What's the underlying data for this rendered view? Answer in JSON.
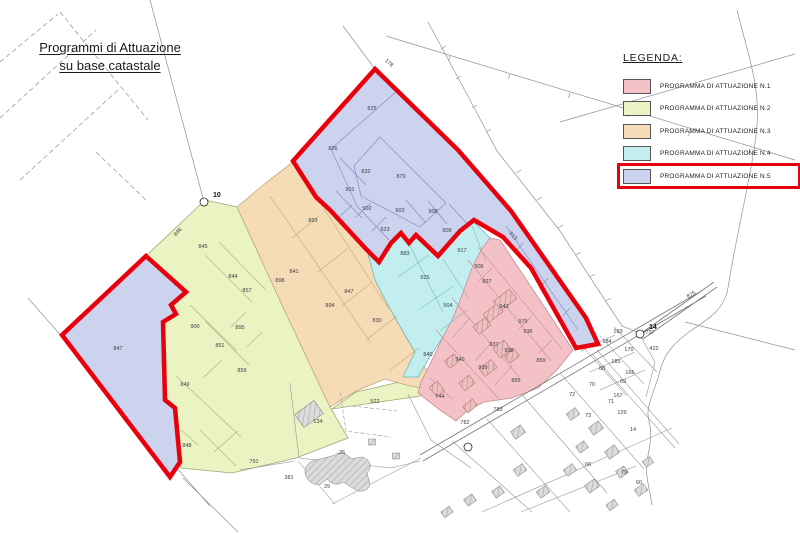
{
  "title": {
    "line1": "Programmi di Attuazione",
    "line2": "su base catastale"
  },
  "legend": {
    "heading": "LEGENDA:",
    "items": [
      {
        "label": "PROGRAMMA DI ATTUAZIONE N.1",
        "color": "#f3c1c6",
        "highlighted": false
      },
      {
        "label": "PROGRAMMA DI ATTUAZIONE N.2",
        "color": "#eaf3c2",
        "highlighted": false
      },
      {
        "label": "PROGRAMMA DI ATTUAZIONE N.3",
        "color": "#f6dcb6",
        "highlighted": false
      },
      {
        "label": "PROGRAMMA DI ATTUAZIONE N.4",
        "color": "#c2eef0",
        "highlighted": false
      },
      {
        "label": "PROGRAMMA DI ATTUAZIONE N.5",
        "color": "#cbd3ee",
        "highlighted": true
      }
    ],
    "highlight_color": "#e8000d"
  },
  "map": {
    "markers": [
      {
        "label": "10",
        "cx": 204,
        "cy": 202,
        "tx": 213,
        "ty": 197
      },
      {
        "label": "14",
        "cx": 640,
        "cy": 334,
        "tx": 649,
        "ty": 329
      },
      {
        "label": "",
        "cx": 468,
        "cy": 447,
        "tx": 0,
        "ty": 0
      }
    ],
    "parcels": [
      {
        "label": "825",
        "x": 372,
        "y": 110
      },
      {
        "label": "826",
        "x": 333,
        "y": 150
      },
      {
        "label": "832",
        "x": 366,
        "y": 173
      },
      {
        "label": "879",
        "x": 401,
        "y": 178
      },
      {
        "label": "901",
        "x": 350,
        "y": 191
      },
      {
        "label": "902",
        "x": 367,
        "y": 210
      },
      {
        "label": "903",
        "x": 400,
        "y": 212
      },
      {
        "label": "908",
        "x": 433,
        "y": 213
      },
      {
        "label": "923",
        "x": 385,
        "y": 231
      },
      {
        "label": "909",
        "x": 447,
        "y": 232
      },
      {
        "label": "813",
        "x": 512,
        "y": 237,
        "r": 47
      },
      {
        "label": "847",
        "x": 118,
        "y": 350
      },
      {
        "label": "846",
        "x": 179,
        "y": 233,
        "r": -50
      },
      {
        "label": "845",
        "x": 203,
        "y": 248
      },
      {
        "label": "844",
        "x": 233,
        "y": 278
      },
      {
        "label": "857",
        "x": 247,
        "y": 292
      },
      {
        "label": "900",
        "x": 195,
        "y": 328
      },
      {
        "label": "895",
        "x": 240,
        "y": 329
      },
      {
        "label": "851",
        "x": 220,
        "y": 347
      },
      {
        "label": "859",
        "x": 242,
        "y": 372
      },
      {
        "label": "849",
        "x": 185,
        "y": 386
      },
      {
        "label": "848",
        "x": 187,
        "y": 447
      },
      {
        "label": "893",
        "x": 313,
        "y": 222
      },
      {
        "label": "898",
        "x": 280,
        "y": 282
      },
      {
        "label": "841",
        "x": 294,
        "y": 273
      },
      {
        "label": "847",
        "x": 349,
        "y": 293
      },
      {
        "label": "894",
        "x": 330,
        "y": 307
      },
      {
        "label": "830",
        "x": 377,
        "y": 322
      },
      {
        "label": "840",
        "x": 428,
        "y": 356
      },
      {
        "label": "883",
        "x": 405,
        "y": 255
      },
      {
        "label": "925",
        "x": 425,
        "y": 279
      },
      {
        "label": "917",
        "x": 462,
        "y": 252
      },
      {
        "label": "906",
        "x": 479,
        "y": 268
      },
      {
        "label": "904",
        "x": 448,
        "y": 307
      },
      {
        "label": "827",
        "x": 487,
        "y": 283
      },
      {
        "label": "943",
        "x": 504,
        "y": 308
      },
      {
        "label": "975",
        "x": 523,
        "y": 323
      },
      {
        "label": "936",
        "x": 528,
        "y": 333
      },
      {
        "label": "937",
        "x": 494,
        "y": 346
      },
      {
        "label": "938",
        "x": 509,
        "y": 352
      },
      {
        "label": "859",
        "x": 541,
        "y": 362
      },
      {
        "label": "940",
        "x": 460,
        "y": 361
      },
      {
        "label": "939",
        "x": 483,
        "y": 369
      },
      {
        "label": "865",
        "x": 516,
        "y": 382
      },
      {
        "label": "744",
        "x": 440,
        "y": 398
      },
      {
        "label": "783",
        "x": 498,
        "y": 411
      },
      {
        "label": "782",
        "x": 465,
        "y": 424
      },
      {
        "label": "522",
        "x": 375,
        "y": 403
      },
      {
        "label": "134",
        "x": 318,
        "y": 423
      },
      {
        "label": "26",
        "x": 342,
        "y": 454
      },
      {
        "label": "29",
        "x": 327,
        "y": 488
      },
      {
        "label": "791",
        "x": 254,
        "y": 463
      },
      {
        "label": "381",
        "x": 289,
        "y": 479
      },
      {
        "label": "737",
        "x": 650,
        "y": 334
      },
      {
        "label": "422",
        "x": 654,
        "y": 350
      },
      {
        "label": "183",
        "x": 618,
        "y": 333
      },
      {
        "label": "184",
        "x": 607,
        "y": 343
      },
      {
        "label": "170",
        "x": 629,
        "y": 351
      },
      {
        "label": "185",
        "x": 616,
        "y": 363
      },
      {
        "label": "68",
        "x": 602,
        "y": 370
      },
      {
        "label": "166",
        "x": 630,
        "y": 374
      },
      {
        "label": "69",
        "x": 623,
        "y": 383
      },
      {
        "label": "70",
        "x": 592,
        "y": 386
      },
      {
        "label": "72",
        "x": 572,
        "y": 396
      },
      {
        "label": "167",
        "x": 618,
        "y": 397
      },
      {
        "label": "71",
        "x": 611,
        "y": 403
      },
      {
        "label": "73",
        "x": 588,
        "y": 417
      },
      {
        "label": "129",
        "x": 622,
        "y": 414
      },
      {
        "label": "14",
        "x": 633,
        "y": 431
      },
      {
        "label": "66",
        "x": 588,
        "y": 466
      },
      {
        "label": "79",
        "x": 624,
        "y": 474
      },
      {
        "label": "60",
        "x": 639,
        "y": 484
      },
      {
        "label": "178",
        "x": 388,
        "y": 64,
        "r": 42
      },
      {
        "label": "875",
        "x": 692,
        "y": 296,
        "r": -30
      }
    ]
  }
}
